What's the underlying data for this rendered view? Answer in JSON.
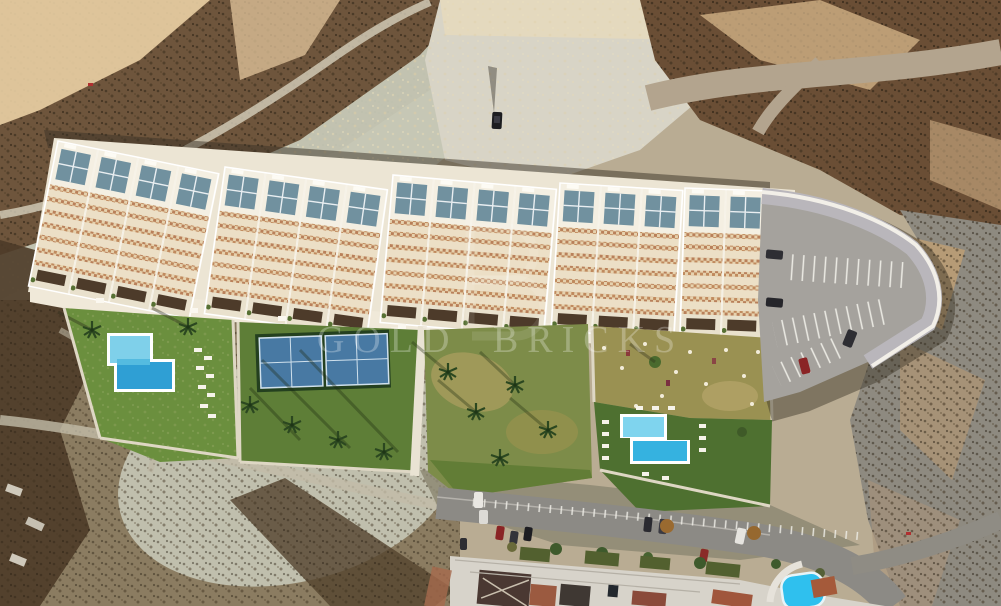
{
  "watermark": {
    "text": "GOLD BRICKS"
  },
  "scene": {
    "description": "Aerial 3D render of a new-build terraced townhouse development with landscaped gardens, two swimming pools, padel courts and a private car park, set on arid scrubland above an existing residential street.",
    "development": {
      "building_blocks": 5,
      "features": [
        "white stepped townhouses",
        "blue roof skylights",
        "lattice terrace balconies",
        "front promenade walkway"
      ],
      "amenities": [
        "L-shaped pool in west garden",
        "stepped pool in east garden",
        "two blue padel courts",
        "palm-planted lawns",
        "car park with white marked bays"
      ]
    },
    "surroundings": [
      "desert scrub hillside",
      "pale dry wash",
      "dirt road to the north-east",
      "eroded slope to the east",
      "existing street with parked cars and houses to the south",
      "neighbouring bright-blue pool at south-east"
    ],
    "vehicles": {
      "car_park_cars": 4,
      "street_cars": 10,
      "lone_car_on_waste_ground": 1
    }
  },
  "palette": {
    "sand": "#b9ac93",
    "scrub_dark": "#4c3b28",
    "scrub_brown": "#6e553c",
    "wash_pale": "#c6c8b6",
    "building_cream": "#efe8d8",
    "roof_glass_blue": "#71919f",
    "lattice_brown": "#c08a5e",
    "lawn_green": "#6b8f3e",
    "lawn_olive": "#9a9152",
    "pool_light": "#7fd0ea",
    "pool_deep": "#2f9fd4",
    "court_blue": "#4879a3",
    "parking_gray": "#a5a29d",
    "road_gray": "#8c8a85",
    "wall_white": "#f2efe8",
    "roof_terracotta": "#9b5a40",
    "watermark_white": "#ffffff"
  }
}
